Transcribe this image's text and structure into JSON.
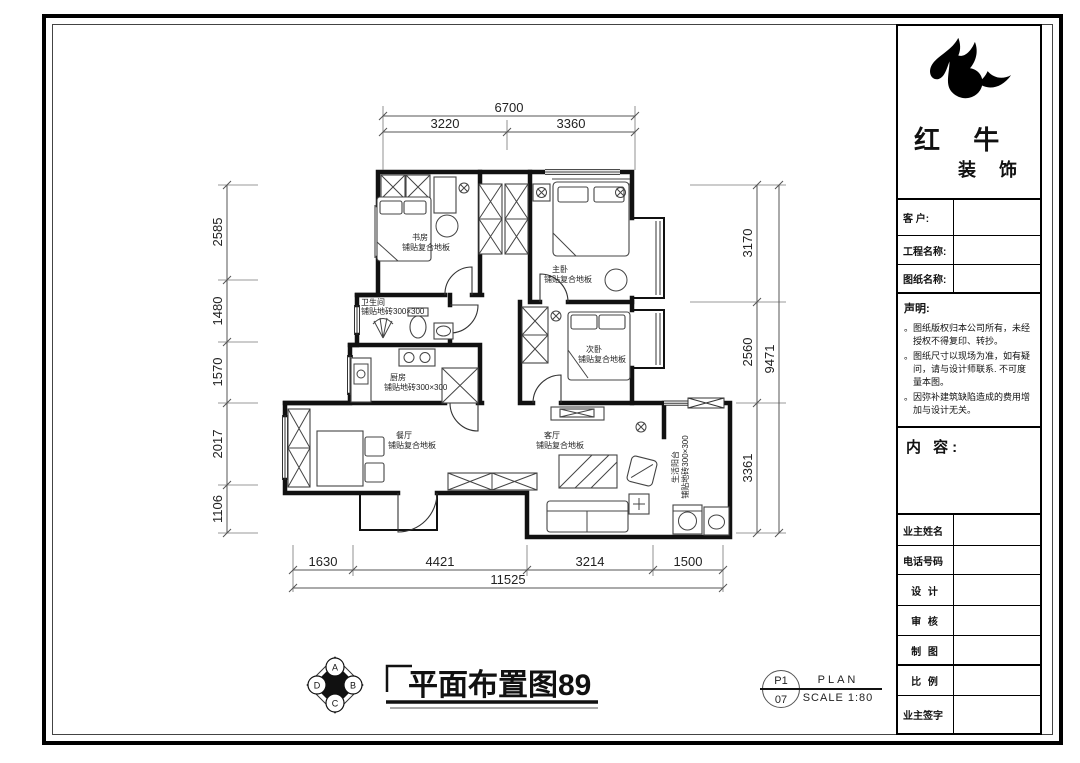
{
  "colors": {
    "ink": "#111111",
    "frame": "#000000",
    "dim_line": "#555555"
  },
  "title_block": {
    "brand": {
      "name": "红 牛",
      "suffix": "装 饰"
    },
    "fields": [
      {
        "label": "客  户:"
      },
      {
        "label": "工程名称:"
      },
      {
        "label": "图纸名称:"
      }
    ],
    "statement": {
      "heading": "声明:",
      "items": [
        "。图纸版权归本公司所有，未经授权不得复印、转抄。",
        "。图纸尺寸以现场为准，如有疑问，请与设计师联系. 不可度量本图。",
        "。因弥补建筑缺陷造成的费用增加与设计无关。"
      ]
    },
    "content_heading": "内 容:",
    "bottom_fields": [
      {
        "label": "业主姓名"
      },
      {
        "label": "电话号码"
      },
      {
        "label": "设 计"
      },
      {
        "label": "审 核"
      },
      {
        "label": "制 图"
      },
      {
        "label": "比 例"
      },
      {
        "label": "业主签字"
      }
    ]
  },
  "plan": {
    "rooms": [
      {
        "name": "书房",
        "floor": "铺贴复合地板"
      },
      {
        "name": "主卧",
        "floor": "铺贴复合地板"
      },
      {
        "name": "次卧",
        "floor": "铺贴复合地板"
      },
      {
        "name": "卫生间",
        "floor": "铺贴地砖300×300"
      },
      {
        "name": "厨房",
        "floor": "铺贴地砖300×300"
      },
      {
        "name": "餐厅",
        "floor": "铺贴复合地板"
      },
      {
        "name": "客厅",
        "floor": "铺贴复合地板"
      },
      {
        "name": "生活阳台",
        "floor": "铺贴地砖300×300"
      }
    ],
    "dimensions": {
      "top": {
        "total": "6700",
        "segments": [
          "3220",
          "3360"
        ]
      },
      "left": {
        "segments": [
          "2585",
          "1480",
          "1570",
          "2017",
          "1106"
        ]
      },
      "right": {
        "total": "9471",
        "segments": [
          "3170",
          "2560",
          "3361"
        ]
      },
      "bottom": {
        "total": "11525",
        "segments": [
          "1630",
          "4421",
          "3214",
          "1500"
        ]
      }
    }
  },
  "footer": {
    "drawing_title": "平面布置图89",
    "compass": {
      "top": "A",
      "right": "B",
      "bottom": "C",
      "left": "D"
    },
    "sheet": {
      "number_top": "P1",
      "number_bottom": "07",
      "type": "PLAN",
      "scale": "SCALE 1:80"
    }
  }
}
